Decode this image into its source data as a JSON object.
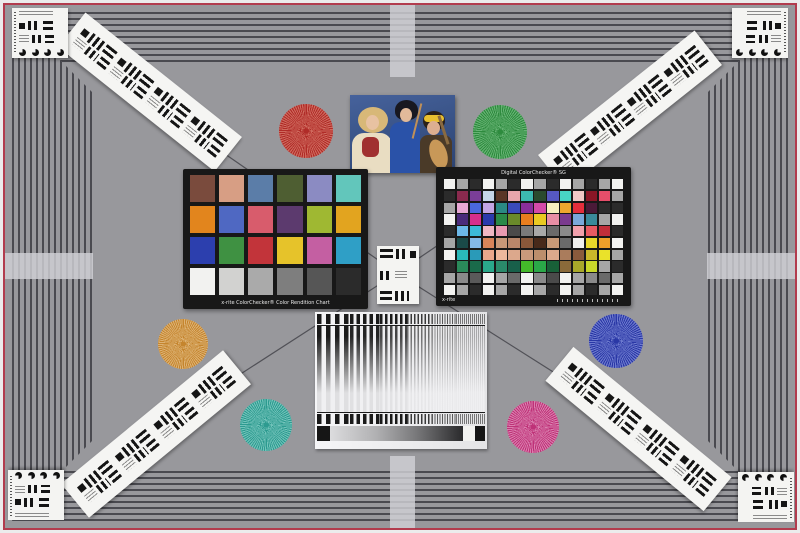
{
  "meta": {
    "description": "Camera resolution and color test chart scene",
    "background": "#98989c",
    "frame_line_color": "#4a4a50",
    "red_border_color": "#b23c4e",
    "crosshair_color": "#d1d1d6"
  },
  "frame": {
    "crossbars": [
      {
        "x": 390,
        "y": 5,
        "w": 25,
        "h": 72
      },
      {
        "x": 390,
        "y": 456,
        "w": 25,
        "h": 72
      },
      {
        "x": 5,
        "y": 253,
        "w": 88,
        "h": 26
      },
      {
        "x": 707,
        "y": 253,
        "w": 88,
        "h": 26
      }
    ],
    "diagonals": [
      [
        92,
        62,
        397,
        273
      ],
      [
        708,
        62,
        397,
        273
      ],
      [
        92,
        470,
        397,
        273
      ],
      [
        708,
        470,
        397,
        273
      ]
    ]
  },
  "corner_cards": [
    {
      "x": 12,
      "y": 8,
      "flip": ""
    },
    {
      "x": 732,
      "y": 8,
      "flip": "x"
    },
    {
      "x": 8,
      "y": 470,
      "flip": "y"
    },
    {
      "x": 738,
      "y": 472,
      "flip": "xy"
    }
  ],
  "strips": [
    {
      "x": 150,
      "y": 92,
      "angle": 38.5,
      "len": 200
    },
    {
      "x": 630,
      "y": 110,
      "angle": -38.5,
      "len": 200
    },
    {
      "x": 156,
      "y": 434,
      "angle": -39.5,
      "len": 210
    },
    {
      "x": 638,
      "y": 429,
      "angle": 39.5,
      "len": 205
    }
  ],
  "stars": [
    {
      "name": "red-star",
      "cx": 306,
      "cy": 131,
      "r": 27,
      "color": "#b02c28",
      "light": "#cf6a5e"
    },
    {
      "name": "green-star",
      "cx": 500,
      "cy": 132,
      "r": 27,
      "color": "#2e8b3e",
      "light": "#66b374"
    },
    {
      "name": "orange-star",
      "cx": 183,
      "cy": 344,
      "r": 25,
      "color": "#c5852e",
      "light": "#ddb274"
    },
    {
      "name": "blue-star",
      "cx": 616,
      "cy": 341,
      "r": 27,
      "color": "#2a38a6",
      "light": "#6d7ace"
    },
    {
      "name": "teal-star",
      "cx": 266,
      "cy": 425,
      "r": 26,
      "color": "#2d9b90",
      "light": "#72c3ba"
    },
    {
      "name": "magenta-star",
      "cx": 533,
      "cy": 427,
      "r": 26,
      "color": "#bf3278",
      "light": "#da7fae"
    }
  ],
  "photo": {
    "x": 350,
    "y": 95,
    "w": 105,
    "h": 78
  },
  "classic_chart": {
    "x": 183,
    "y": 169,
    "w": 185,
    "h": 140,
    "label": "x-rite ColorChecker® Color Rendition Chart",
    "cols": 6,
    "rows": 4,
    "patches": [
      "#7a4b3d",
      "#d79e84",
      "#5b7da8",
      "#4e5e32",
      "#8b8bc2",
      "#62c6bb",
      "#e2851d",
      "#4f68c2",
      "#d85c6c",
      "#5c3a6e",
      "#9fb832",
      "#e2a41f",
      "#2c3fae",
      "#3f9142",
      "#c2343a",
      "#e6c32a",
      "#c45fa2",
      "#2f9fc6",
      "#f2f2f0",
      "#d2d2d0",
      "#aaaaaa",
      "#7e7e7e",
      "#565656",
      "#2b2b2b"
    ]
  },
  "sg_chart": {
    "x": 436,
    "y": 167,
    "w": 195,
    "h": 139,
    "title": "Digital ColorChecker® SG",
    "brand": "x-rite",
    "cols": 14,
    "rows": 10,
    "patches": [
      "#f2f2f0",
      "#a6a6a6",
      "#2b2b2b",
      "#f2f2f0",
      "#a6a6a6",
      "#2b2b2b",
      "#f2f2f0",
      "#a6a6a6",
      "#2b2b2b",
      "#f2f2f0",
      "#a6a6a6",
      "#2b2b2b",
      "#a6a6a6",
      "#f2f2f0",
      "#2b2b2b",
      "#8a2a4e",
      "#7a3e98",
      "#c5d6e8",
      "#5a3626",
      "#e8a6ac",
      "#3cb8b0",
      "#2a4a2e",
      "#5658c0",
      "#48d4c4",
      "#f0c8c6",
      "#8a1626",
      "#e64e6a",
      "#a6a6a6",
      "#a6a6a6",
      "#e8a8d4",
      "#4a68de",
      "#c4a6e4",
      "#2a8a84",
      "#3a4aba",
      "#8a2e9a",
      "#d44aa8",
      "#f6f0be",
      "#eea62e",
      "#e42e3c",
      "#4a1a38",
      "#2b2b2b",
      "#2b2b2b",
      "#f2f2f0",
      "#4a2a7a",
      "#d62e8c",
      "#2a3aac",
      "#2a8a48",
      "#6a8a2a",
      "#e87e1e",
      "#eaca22",
      "#e88ea4",
      "#7a3a8e",
      "#7aa8da",
      "#3a8a9a",
      "#a6a6a6",
      "#f2f2f0",
      "#2b2b2b",
      "#6cb8e8",
      "#3cb8d8",
      "#f0b8c4",
      "#e89ab0",
      "#4a4a4a",
      "#7a7a7a",
      "#a8a8a8",
      "#6a6a6a",
      "#8a8a8a",
      "#f0a0ac",
      "#e85a62",
      "#c22e3a",
      "#2b2b2b",
      "#a6a6a6",
      "#1a4a48",
      "#84b8e8",
      "#d8845a",
      "#c89878",
      "#b8866a",
      "#8a583a",
      "#48291a",
      "#c89a78",
      "#6a6a6a",
      "#f0f0ee",
      "#ead82a",
      "#f0a02a",
      "#f2f2f0",
      "#f2f2f0",
      "#2ab8b8",
      "#2a9ab8",
      "#eaa88c",
      "#edb89c",
      "#dca88c",
      "#ca9a7c",
      "#bc8e6c",
      "#dca98c",
      "#aa7c5c",
      "#8a5a3c",
      "#cab82a",
      "#eae22a",
      "#a6a6a6",
      "#2b2b2b",
      "#2a8a5a",
      "#1a6a4a",
      "#2aa88a",
      "#2a8a6a",
      "#18604a",
      "#44b82a",
      "#2aa848",
      "#186038",
      "#8a6a3a",
      "#a8a82a",
      "#c8d82a",
      "#a6a6a6",
      "#2b2b2b",
      "#a6a6a6",
      "#8a8a8a",
      "#5a5a5a",
      "#f2f2f0",
      "#a6a6a6",
      "#6a6a6a",
      "#f2f2f0",
      "#8a8a8a",
      "#4a4a4a",
      "#f2f2f0",
      "#a6a6a6",
      "#8a8a8a",
      "#6a6a6a",
      "#a6a6a6",
      "#f2f2f0",
      "#a6a6a6",
      "#2b2b2b",
      "#f2f2f0",
      "#a6a6a6",
      "#2b2b2b",
      "#f2f2f0",
      "#a6a6a6",
      "#2b2b2b",
      "#f2f2f0",
      "#a6a6a6",
      "#2b2b2b",
      "#a6a6a6",
      "#f2f2f0"
    ]
  },
  "wedge_card": {
    "x": 315,
    "y": 312,
    "w": 172,
    "h": 137,
    "segments": [
      {
        "w": 34,
        "p": 9,
        "o": 1
      },
      {
        "w": 30,
        "p": 6.5,
        "o": 0.95
      },
      {
        "w": 28,
        "p": 5,
        "o": 0.8
      },
      {
        "w": 26,
        "p": 3.5,
        "o": 0.6
      },
      {
        "w": 24,
        "p": 2.5,
        "o": 0.45
      },
      {
        "w": 30,
        "p": 2,
        "o": 0.3
      }
    ]
  },
  "center_card": {
    "x": 377,
    "y": 246,
    "w": 42,
    "h": 58
  }
}
